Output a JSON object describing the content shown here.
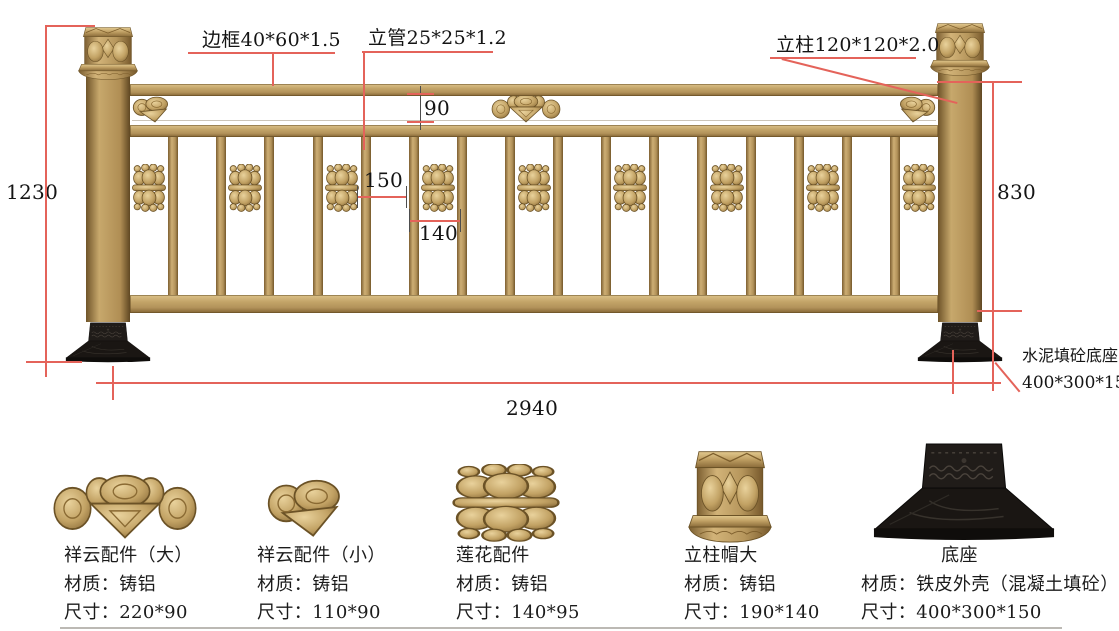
{
  "diagram": {
    "labels": {
      "frame": "边框40*60*1.5",
      "pipe": "立管25*25*1.2",
      "post": "立柱120*120*2.0",
      "base_name": "水泥填砼底座",
      "base_size": "400*300*150"
    },
    "dimensions": {
      "total_height": "1230",
      "band_height": "90",
      "picket_gap": "150",
      "lotus_gap": "140",
      "panel_height": "830",
      "total_width": "2940"
    },
    "fence": {
      "picket_count": 16,
      "lotus_count": 9,
      "cloud_count": 3
    }
  },
  "components": [
    {
      "name": "祥云配件（大）",
      "material": "材质：铸铝",
      "size": "尺寸：220*90",
      "icon": "cloud-large"
    },
    {
      "name": "祥云配件（小）",
      "material": "材质：铸铝",
      "size": "尺寸：110*90",
      "icon": "cloud-small"
    },
    {
      "name": "莲花配件",
      "material": "材质：铸铝",
      "size": "尺寸：140*95",
      "icon": "lotus"
    },
    {
      "name": "立柱帽大",
      "material": "材质：铸铝",
      "size": "尺寸：190*140",
      "icon": "post-cap"
    },
    {
      "name": "底座",
      "material": "材质：铁皮外壳（混凝土填砼）",
      "size": "尺寸：400*300*150",
      "icon": "base"
    }
  ],
  "colors": {
    "gold": "#bb9c61",
    "gold_dark": "#7d5f31",
    "dimension_red": "#e4635a",
    "base_black": "#1a1613",
    "text": "#141414"
  }
}
